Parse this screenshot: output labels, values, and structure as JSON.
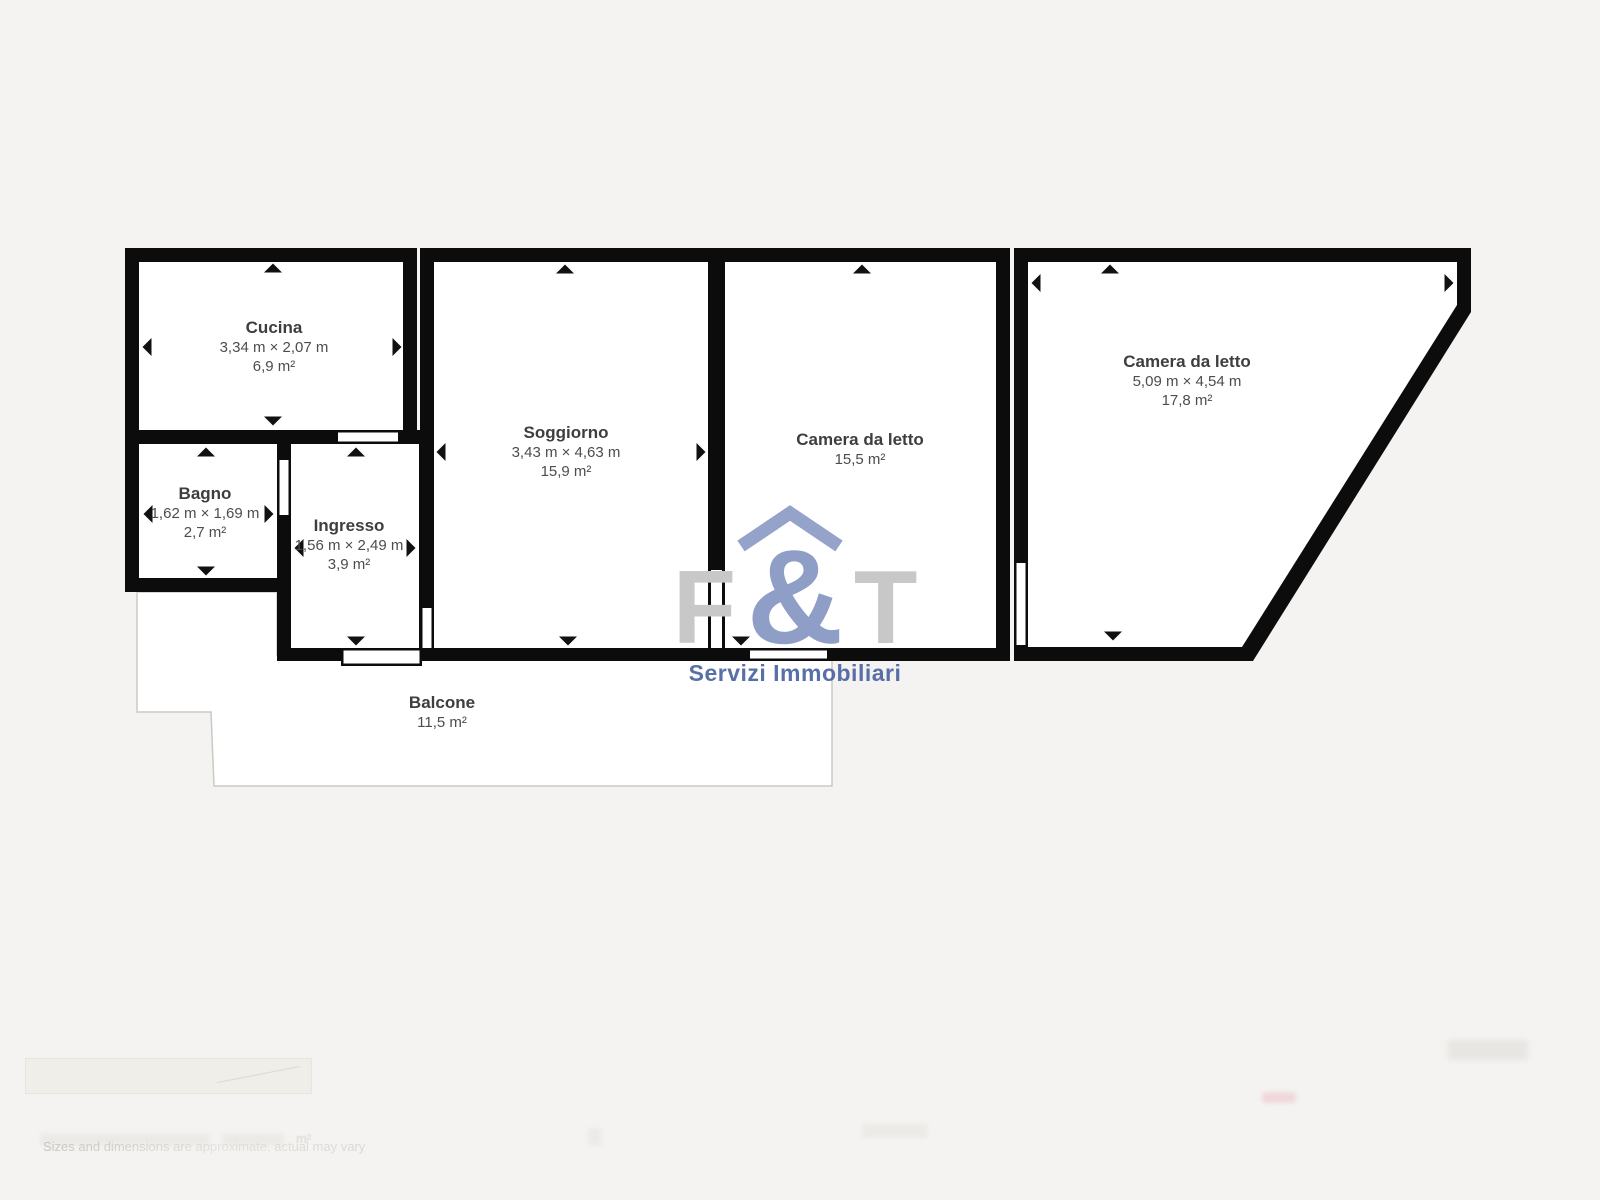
{
  "colors": {
    "background": "#f4f3f1",
    "wall": "#0c0c0c",
    "room_fill": "#ffffff",
    "balcony_border": "#ccc9c4",
    "label_name": "#3e3e3e",
    "label_dims": "#4d4d4d",
    "logo_gray": "#c8c8c8",
    "logo_slate_blue": "#8f9ec7",
    "logo_tagline_blue": "#47619e"
  },
  "rooms": [
    {
      "id": "cucina",
      "name": "Cucina",
      "dimensions": "3,34 m × 2,07 m",
      "area": "6,9 m²"
    },
    {
      "id": "bagno",
      "name": "Bagno",
      "dimensions": "1,62 m × 1,69 m",
      "area": "2,7 m²"
    },
    {
      "id": "ingresso",
      "name": "Ingresso",
      "dimensions": "1,56 m × 2,49 m",
      "area": "3,9 m²"
    },
    {
      "id": "soggiorno",
      "name": "Soggiorno",
      "dimensions": "3,43 m × 4,63 m",
      "area": "15,9 m²"
    },
    {
      "id": "camera-1",
      "name": "Camera da letto",
      "area": "15,5 m²"
    },
    {
      "id": "camera-2",
      "name": "Camera da letto",
      "dimensions": "5,09 m × 4,54 m",
      "area": "17,8 m²"
    },
    {
      "id": "balcone",
      "name": "Balcone",
      "area": "11,5 m²"
    }
  ],
  "logo": {
    "letter_f": "F",
    "ampersand": "&",
    "letter_t": "T",
    "tagline": "Servizi Immobiliari"
  },
  "footer": {
    "disclaimer": "Sizes and dimensions are approximate, actual may vary",
    "area_unit": "m²"
  }
}
